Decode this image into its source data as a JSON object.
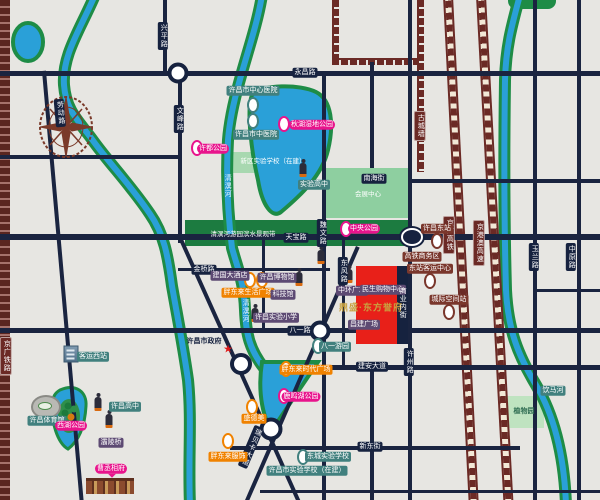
{
  "map": {
    "colors": {
      "background": "#e7e6e2",
      "road": "#1a2440",
      "river": "#2aa0d8",
      "bank_green": "#1e8c46",
      "park_green": "#8ecfa0",
      "rail_maroon": "#6b2a25",
      "poi_teal": "#41807e",
      "poi_magenta": "#e8148c",
      "poi_orange": "#f08200",
      "poi_purple": "#5d4a73",
      "poi_maroon": "#7a372c",
      "project_red": "#e82019",
      "project_gold": "#c9a23f"
    },
    "labels": [
      {
        "n": "road-label",
        "t": "永昌路",
        "c": "road",
        "x": 305,
        "y": 73,
        "v": false,
        "a": false
      },
      {
        "n": "road-label",
        "t": "天宝路",
        "c": "road",
        "x": 296,
        "y": 238,
        "v": false,
        "a": false
      },
      {
        "n": "road-label",
        "t": "八一路",
        "c": "road",
        "x": 300,
        "y": 331,
        "v": false,
        "a": false
      },
      {
        "n": "road-label",
        "t": "建安大道",
        "c": "road",
        "x": 372,
        "y": 367,
        "v": false,
        "a": false
      },
      {
        "n": "road-label",
        "t": "新东街",
        "c": "road",
        "x": 370,
        "y": 447,
        "v": false,
        "a": false
      },
      {
        "n": "road-label",
        "t": "金桥路",
        "c": "road",
        "x": 204,
        "y": 270,
        "v": false,
        "a": false
      },
      {
        "n": "road-label",
        "t": "南海街",
        "c": "road",
        "x": 374,
        "y": 179,
        "v": false,
        "a": false
      },
      {
        "n": "road-label",
        "t": "兴平路",
        "c": "road",
        "x": 163,
        "y": 36,
        "v": true,
        "a": false
      },
      {
        "n": "road-label",
        "t": "劳动路",
        "c": "road",
        "x": 60,
        "y": 113,
        "v": true,
        "a": false,
        "r": -5
      },
      {
        "n": "road-label",
        "t": "文峰路",
        "c": "road",
        "x": 179,
        "y": 119,
        "v": true,
        "a": false
      },
      {
        "n": "road-label",
        "t": "魏文路",
        "c": "road",
        "x": 322,
        "y": 233,
        "v": true,
        "a": false
      },
      {
        "n": "road-label",
        "t": "东风路",
        "c": "road",
        "x": 343,
        "y": 271,
        "v": true,
        "a": false
      },
      {
        "n": "road-label",
        "t": "许州路",
        "c": "road",
        "x": 409,
        "y": 362,
        "v": true,
        "a": false
      },
      {
        "n": "road-label",
        "t": "玉兰路",
        "c": "road",
        "x": 534,
        "y": 257,
        "v": true,
        "a": false
      },
      {
        "n": "road-label",
        "t": "中原路",
        "c": "road",
        "x": 571,
        "y": 257,
        "v": true,
        "a": false
      },
      {
        "n": "road-label",
        "t": "瑞贝卡大道",
        "c": "road",
        "x": 251,
        "y": 447,
        "v": true,
        "a": false,
        "r": 23
      },
      {
        "n": "rail-label",
        "t": "京广高铁",
        "c": "rail",
        "x": 449,
        "y": 235,
        "v": true,
        "a": false
      },
      {
        "n": "rail-label",
        "t": "京港澳高速",
        "c": "rail",
        "x": 479,
        "y": 243,
        "v": true,
        "a": false
      },
      {
        "n": "rail-label",
        "t": "京广铁路",
        "c": "rail",
        "x": 6,
        "y": 356,
        "v": true,
        "a": false
      },
      {
        "n": "wall-label",
        "t": "古城墙",
        "c": "rail",
        "x": 420,
        "y": 126,
        "v": true,
        "a": false
      },
      {
        "n": "river-label",
        "t": "清潩河",
        "c": "riv",
        "x": 227,
        "y": 186,
        "v": true,
        "a": false
      },
      {
        "n": "river-label",
        "t": "清潩河",
        "c": "riv",
        "x": 245,
        "y": 311,
        "v": true,
        "a": false
      },
      {
        "n": "river-label",
        "t": "饮马河",
        "c": "teal",
        "x": 553,
        "y": 391,
        "v": false,
        "a": false
      },
      {
        "n": "poi-label",
        "t": "许昌市中心医院",
        "c": "teal",
        "x": 253,
        "y": 91,
        "v": false,
        "a": true
      },
      {
        "n": "poi-label",
        "t": "许昌市中医院",
        "c": "teal",
        "x": 256,
        "y": 135,
        "v": false,
        "a": true
      },
      {
        "n": "poi-label",
        "t": "实验高中",
        "c": "teal",
        "x": 314,
        "y": 185,
        "v": false,
        "a": true
      },
      {
        "n": "poi-label",
        "t": "八一游园",
        "c": "teal",
        "x": 335,
        "y": 347,
        "v": false,
        "a": true
      },
      {
        "n": "poi-label",
        "t": "东城实验学校",
        "c": "teal",
        "x": 328,
        "y": 457,
        "v": false,
        "a": true
      },
      {
        "n": "poi-label",
        "t": "许昌市实验学校（在建）",
        "c": "teal",
        "x": 307,
        "y": 471,
        "v": false,
        "a": true
      },
      {
        "n": "poi-label",
        "t": "许昌体育馆",
        "c": "teal",
        "x": 47,
        "y": 421,
        "v": false,
        "a": true
      },
      {
        "n": "poi-label",
        "t": "客运西站",
        "c": "teal",
        "x": 93,
        "y": 357,
        "v": false,
        "a": true
      },
      {
        "n": "poi-label",
        "t": "许昌高中",
        "c": "teal",
        "x": 125,
        "y": 407,
        "v": false,
        "a": true
      },
      {
        "n": "poi-label",
        "t": "植物园",
        "c": "greentext",
        "x": 524,
        "y": 412,
        "v": false,
        "a": true
      },
      {
        "n": "area-label",
        "t": "清潩河游园滨水景观带",
        "c": "white",
        "x": 243,
        "y": 235,
        "v": false,
        "a": false
      },
      {
        "n": "area-label",
        "t": "会展中心",
        "c": "white",
        "x": 368,
        "y": 195,
        "v": false,
        "a": false
      },
      {
        "n": "area-label",
        "t": "新区实验学校（在建）",
        "c": "white",
        "x": 273,
        "y": 162,
        "v": false,
        "a": false
      },
      {
        "n": "poi-label",
        "t": "秋湖湿地公园",
        "c": "mag",
        "x": 312,
        "y": 125,
        "v": false,
        "a": true
      },
      {
        "n": "poi-label",
        "t": "许都公园",
        "c": "mag",
        "x": 213,
        "y": 149,
        "v": false,
        "a": true
      },
      {
        "n": "poi-label",
        "t": "中央公园",
        "c": "mag",
        "x": 364,
        "y": 229,
        "v": false,
        "a": true
      },
      {
        "n": "poi-label",
        "t": "鹿鸣湖公园",
        "c": "mag",
        "x": 301,
        "y": 397,
        "v": false,
        "a": true
      },
      {
        "n": "poi-label",
        "t": "西湖公园",
        "c": "mag",
        "x": 71,
        "y": 426,
        "v": false,
        "a": true
      },
      {
        "n": "poi-label",
        "t": "曹丞相府",
        "c": "mag bubble",
        "x": 111,
        "y": 469,
        "v": false,
        "a": true
      },
      {
        "n": "poi-label",
        "t": "胖东来生活广场",
        "c": "org",
        "x": 248,
        "y": 293,
        "v": false,
        "a": true
      },
      {
        "n": "poi-label",
        "t": "胖东来时代广场",
        "c": "org",
        "x": 306,
        "y": 370,
        "v": false,
        "a": true
      },
      {
        "n": "poi-label",
        "t": "盛德美",
        "c": "org",
        "x": 254,
        "y": 419,
        "v": false,
        "a": true
      },
      {
        "n": "poi-label",
        "t": "胖东来服饰",
        "c": "org",
        "x": 228,
        "y": 457,
        "v": false,
        "a": true
      },
      {
        "n": "poi-label",
        "t": "建国大酒店",
        "c": "pur",
        "x": 230,
        "y": 276,
        "v": false,
        "a": true
      },
      {
        "n": "poi-label",
        "t": "许昌博物馆",
        "c": "pur",
        "x": 277,
        "y": 278,
        "v": false,
        "a": true
      },
      {
        "n": "poi-label",
        "t": "科技馆",
        "c": "pur",
        "x": 283,
        "y": 295,
        "v": false,
        "a": true
      },
      {
        "n": "poi-label",
        "t": "许昌实验小学",
        "c": "pur",
        "x": 276,
        "y": 318,
        "v": false,
        "a": true
      },
      {
        "n": "poi-label",
        "t": "中环广场",
        "c": "pur",
        "x": 352,
        "y": 291,
        "v": false,
        "a": true
      },
      {
        "n": "poi-label",
        "t": "民生购物中心",
        "c": "pur",
        "x": 383,
        "y": 290,
        "v": false,
        "a": true
      },
      {
        "n": "poi-label",
        "t": "昌建广场",
        "c": "pur",
        "x": 364,
        "y": 325,
        "v": false,
        "a": true
      },
      {
        "n": "poi-label",
        "t": "灞陵桥",
        "c": "pur",
        "x": 111,
        "y": 443,
        "v": false,
        "a": true
      },
      {
        "n": "poi-label",
        "t": "许昌东站",
        "c": "mar",
        "x": 437,
        "y": 229,
        "v": false,
        "a": true
      },
      {
        "n": "poi-label",
        "t": "高铁商务区",
        "c": "mar",
        "x": 422,
        "y": 257,
        "v": false,
        "a": true
      },
      {
        "n": "poi-label",
        "t": "东站客运中心",
        "c": "mar",
        "x": 430,
        "y": 269,
        "v": false,
        "a": true
      },
      {
        "n": "poi-label",
        "t": "城际空间站",
        "c": "mar",
        "x": 449,
        "y": 300,
        "v": false,
        "a": true
      },
      {
        "n": "government-label",
        "t": "许昌市政府",
        "c": "plain",
        "x": 204,
        "y": 342,
        "v": false,
        "a": true
      },
      {
        "n": "project-name-label",
        "t": "鼎盛·东方誉府",
        "c": "gold",
        "x": 371,
        "y": 308,
        "v": false,
        "a": true
      },
      {
        "n": "street-label",
        "t": "商业内街",
        "c": "strip",
        "x": 402,
        "y": 303,
        "v": true,
        "a": false
      }
    ],
    "icons": [
      {
        "n": "hospital-marker-icon",
        "k": "oval",
        "col": "#41807e",
        "x": 253,
        "y": 105,
        "a": true
      },
      {
        "n": "hospital-marker-icon",
        "k": "oval",
        "col": "#41807e",
        "x": 253,
        "y": 121,
        "a": true
      },
      {
        "n": "park-marker-icon",
        "k": "oval",
        "col": "#e8148c",
        "x": 197,
        "y": 148,
        "a": true
      },
      {
        "n": "park-marker-icon",
        "k": "oval",
        "col": "#e8148c",
        "x": 284,
        "y": 124,
        "a": true
      },
      {
        "n": "park-marker-icon",
        "k": "oval",
        "col": "#e8148c",
        "x": 346,
        "y": 229,
        "a": true
      },
      {
        "n": "park-marker-icon",
        "k": "oval",
        "col": "#e8148c",
        "x": 284,
        "y": 396,
        "a": true
      },
      {
        "n": "shop-marker-icon",
        "k": "oval",
        "col": "#f08200",
        "x": 250,
        "y": 280,
        "a": true
      },
      {
        "n": "shop-marker-icon",
        "k": "oval",
        "col": "#f08200",
        "x": 262,
        "y": 280,
        "a": true
      },
      {
        "n": "shop-marker-icon",
        "k": "oval",
        "col": "#f08200",
        "x": 286,
        "y": 369,
        "a": true
      },
      {
        "n": "shop-marker-icon",
        "k": "oval",
        "col": "#f08200",
        "x": 252,
        "y": 407,
        "a": true
      },
      {
        "n": "shop-marker-icon",
        "k": "oval",
        "col": "#f08200",
        "x": 228,
        "y": 441,
        "a": true
      },
      {
        "n": "station-marker-icon",
        "k": "oval",
        "col": "#7a372c",
        "x": 437,
        "y": 241,
        "a": true
      },
      {
        "n": "station-marker-icon",
        "k": "oval",
        "col": "#7a372c",
        "x": 430,
        "y": 281,
        "a": true
      },
      {
        "n": "station-marker-icon",
        "k": "oval",
        "col": "#7a372c",
        "x": 449,
        "y": 312,
        "a": true
      },
      {
        "n": "school-marker-icon",
        "k": "oval",
        "col": "#41807e",
        "x": 318,
        "y": 346,
        "a": true
      },
      {
        "n": "school-marker-icon",
        "k": "oval",
        "col": "#41807e",
        "x": 303,
        "y": 457,
        "a": true
      },
      {
        "n": "statue-icon",
        "k": "statue",
        "x": 303,
        "y": 170,
        "a": false
      },
      {
        "n": "statue-icon",
        "k": "statue",
        "x": 321,
        "y": 257,
        "a": false
      },
      {
        "n": "statue-icon",
        "k": "statue",
        "x": 299,
        "y": 279,
        "a": false
      },
      {
        "n": "statue-icon",
        "k": "statue",
        "x": 349,
        "y": 276,
        "a": false
      },
      {
        "n": "statue-icon",
        "k": "statue",
        "x": 255,
        "y": 315,
        "a": false
      },
      {
        "n": "statue-icon",
        "k": "statue",
        "x": 98,
        "y": 404,
        "a": false
      },
      {
        "n": "guanyu-statue-icon",
        "k": "statue",
        "x": 109,
        "y": 421,
        "a": false
      },
      {
        "n": "government-star-icon",
        "k": "star",
        "t": "★",
        "x": 228,
        "y": 350,
        "a": false
      },
      {
        "n": "roundabout",
        "k": "round",
        "x": 178,
        "y": 73,
        "d": 13,
        "a": false
      },
      {
        "n": "roundabout",
        "k": "round",
        "x": 241,
        "y": 364,
        "d": 14,
        "a": false
      },
      {
        "n": "roundabout",
        "k": "round",
        "x": 271,
        "y": 429,
        "d": 15,
        "a": false
      },
      {
        "n": "roundabout",
        "k": "round",
        "x": 320,
        "y": 331,
        "d": 13,
        "a": false
      },
      {
        "n": "train-station-icon",
        "k": "station",
        "x": 412,
        "y": 237,
        "a": true
      },
      {
        "n": "stadium-icon",
        "k": "stadium",
        "x": 46,
        "y": 407,
        "a": false
      },
      {
        "n": "bus-station-icon",
        "k": "bus",
        "x": 71,
        "y": 354,
        "a": false
      },
      {
        "n": "heritage-site-icon",
        "k": "heritage",
        "x": 110,
        "y": 486,
        "a": false
      },
      {
        "n": "park-trees-icon",
        "k": "trees",
        "x": 68,
        "y": 406,
        "a": false
      }
    ]
  }
}
